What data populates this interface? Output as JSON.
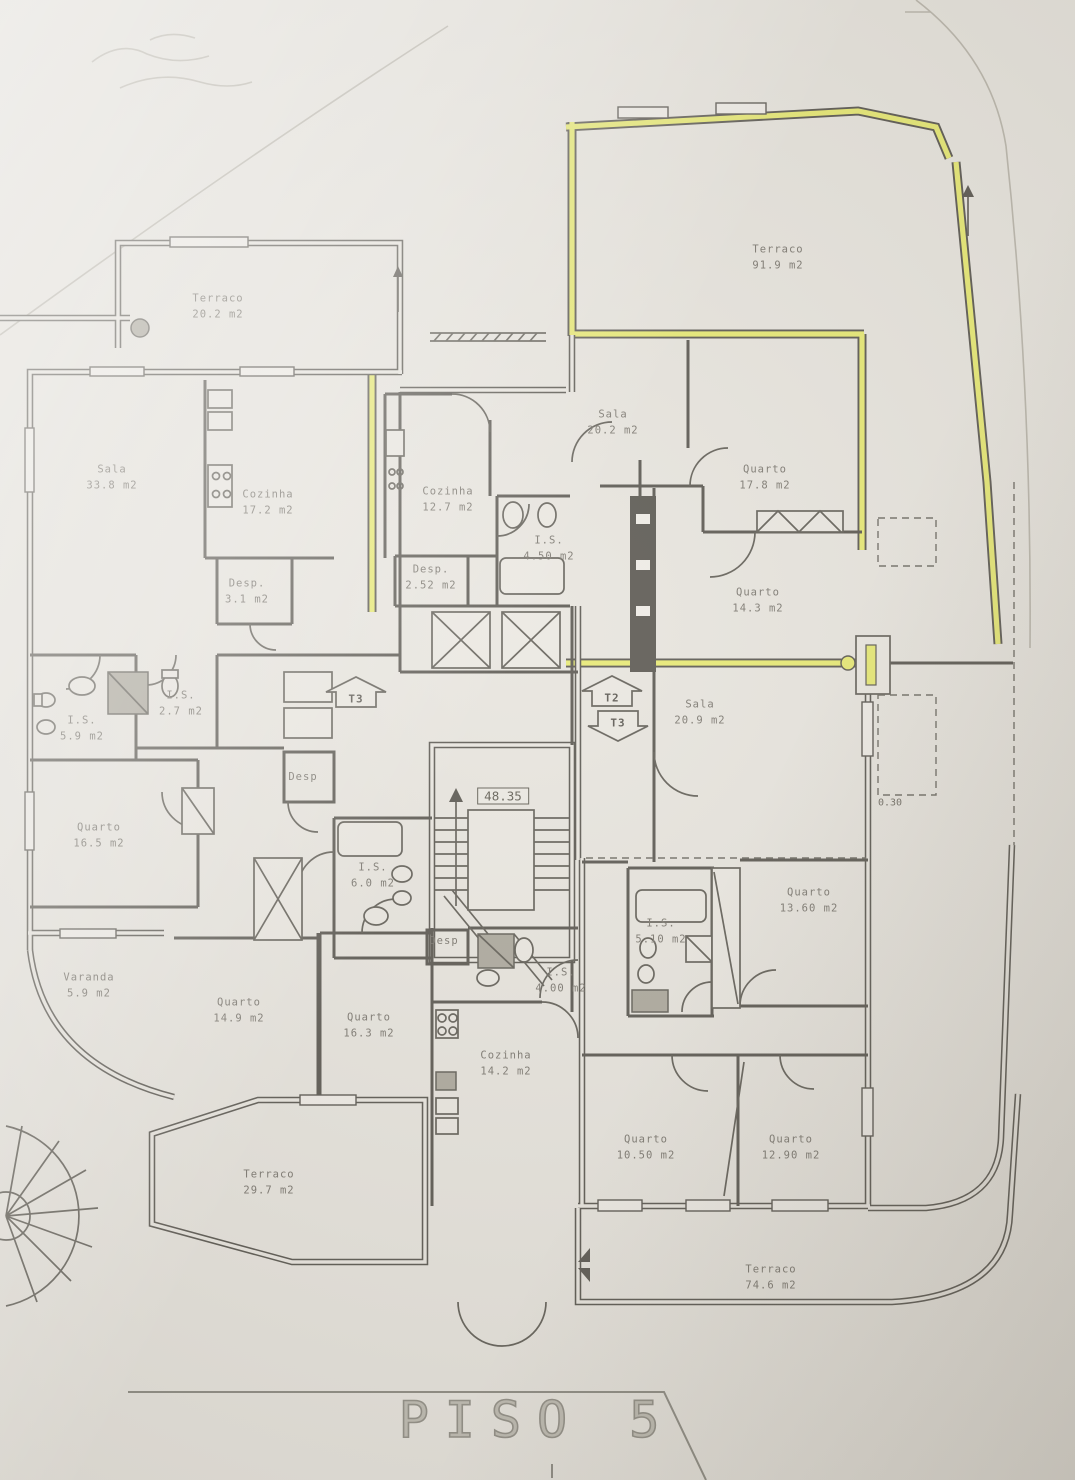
{
  "colors": {
    "paper": "#e7e4dd",
    "ink": "#55524b",
    "label_ink": "#76726a",
    "highlight": "#e7e96f",
    "title_ink": "#8e8b82"
  },
  "drawing": {
    "title": "PISO 5",
    "stair_elevation": "48.35",
    "dimension_note": "0.30",
    "unit_markers": [
      {
        "label": "T3",
        "direction": "up"
      },
      {
        "label": "T2",
        "direction": "up"
      },
      {
        "label": "T3",
        "direction": "down"
      }
    ],
    "rooms": [
      {
        "name": "Terraco",
        "area": "20.2 m2"
      },
      {
        "name": "Terraco",
        "area": "91.9 m2"
      },
      {
        "name": "Sala",
        "area": "33.8 m2"
      },
      {
        "name": "Cozinha",
        "area": "17.2 m2"
      },
      {
        "name": "Desp.",
        "area": "3.1 m2"
      },
      {
        "name": "Cozinha",
        "area": "12.7 m2"
      },
      {
        "name": "Desp.",
        "area": "2.52 m2"
      },
      {
        "name": "I.S.",
        "area": "4.50 m2"
      },
      {
        "name": "Sala",
        "area": "20.2 m2"
      },
      {
        "name": "Quarto",
        "area": "17.8 m2"
      },
      {
        "name": "Quarto",
        "area": "14.3 m2"
      },
      {
        "name": "Sala",
        "area": "20.9 m2"
      },
      {
        "name": "I.S.",
        "area": "5.9 m2"
      },
      {
        "name": "I.S.",
        "area": "2.7 m2"
      },
      {
        "name": "Quarto",
        "area": "16.5 m2"
      },
      {
        "name": "Desp",
        "area": ""
      },
      {
        "name": "I.S.",
        "area": "6.0 m2"
      },
      {
        "name": "Quarto",
        "area": "13.60 m2"
      },
      {
        "name": "I.S.",
        "area": "5.10 m2"
      },
      {
        "name": "Varanda",
        "area": "5.9 m2"
      },
      {
        "name": "Quarto",
        "area": "14.9 m2"
      },
      {
        "name": "Quarto",
        "area": "16.3 m2"
      },
      {
        "name": "Cozinha",
        "area": "14.2 m2"
      },
      {
        "name": "Desp",
        "area": ""
      },
      {
        "name": "I.S.",
        "area": "4.00 m2"
      },
      {
        "name": "Quarto",
        "area": "10.50 m2"
      },
      {
        "name": "Quarto",
        "area": "12.90 m2"
      },
      {
        "name": "Terraco",
        "area": "29.7 m2"
      },
      {
        "name": "Terraco",
        "area": "74.6 m2"
      }
    ]
  }
}
